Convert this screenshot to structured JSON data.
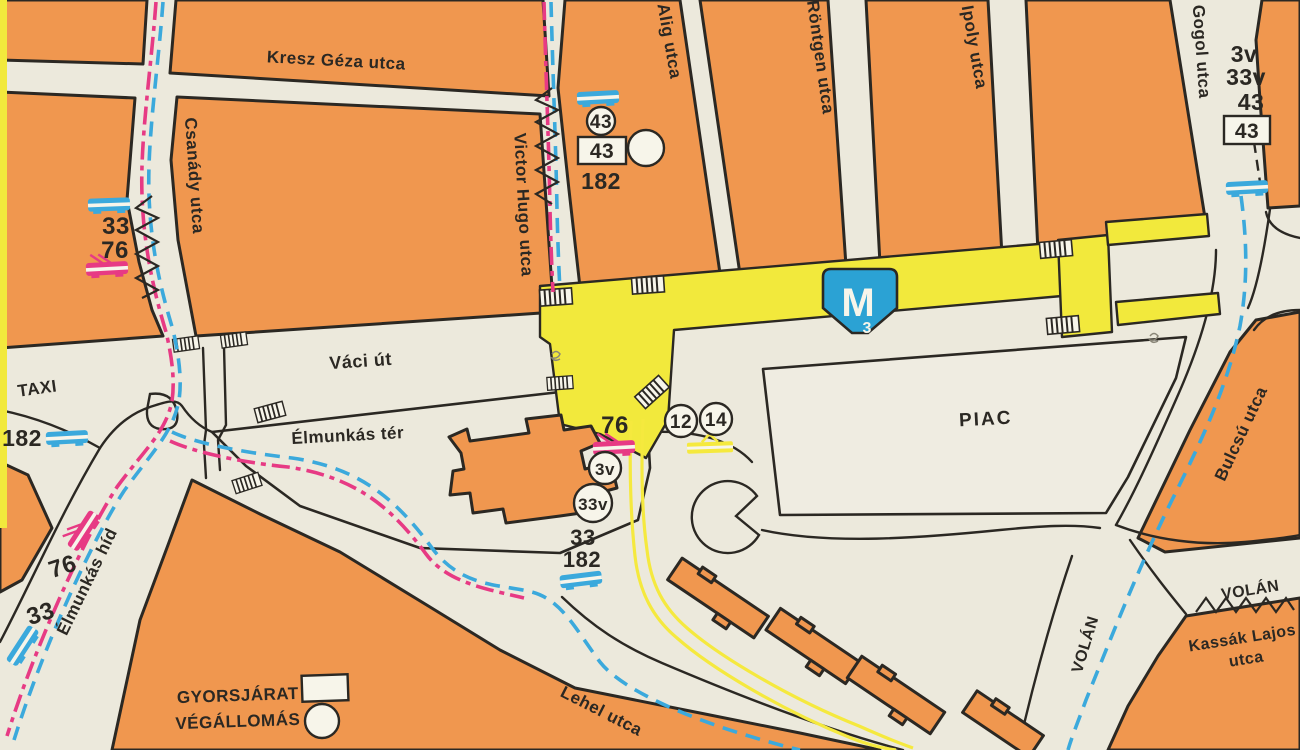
{
  "colors": {
    "background": "#ECE9DC",
    "paper": "#F7F5EA",
    "block_orange": "#F0974F",
    "ink": "#2B2823",
    "metro_yellow": "#F2E93C",
    "tram_yellow": "#F5E93E",
    "route_blue": "#3BA9DC",
    "route_pink": "#E73A84",
    "badge_blue": "#2BA2D4",
    "piac": "#EFECE1"
  },
  "street_labels": {
    "kresz_geza": "Kresz Géza utca",
    "csanady": "Csanády utca",
    "victor_hugo": "Victor Hugo utca",
    "alig": "Alig utca",
    "rontgen": "Röntgen utca",
    "ipoly": "Ipoly utca",
    "gogol": "Gogol utca",
    "vaci_ut": "Váci út",
    "elmunkas_ter": "Élmunkás tér",
    "elmunkas_hid": "Élmunkás híd",
    "lehel": "Lehel utca",
    "bulcsu": "Bulcsú utca",
    "kassak_lajos": "Kassák Lajos",
    "kassak_utca": "utca",
    "volan_east": "VOLÁN",
    "volan_south": "VOLÁN",
    "taxi": "TAXI",
    "piac": "PIAC"
  },
  "legend": {
    "express": "GYORSJÁRAT",
    "terminus": "VÉGÁLLOMÁS"
  },
  "metro_badge": {
    "letter": "M",
    "line_number": "3"
  },
  "stops": {
    "nw_bus_33": "33",
    "nw_trolley_76": "76",
    "west_bus_182": "182",
    "bridge_trolley_76": "76",
    "bridge_bus_33": "33",
    "victor_hugo_circle_43": "43",
    "victor_hugo_box_43": "43",
    "victor_hugo_182": "182",
    "center_trolley_76": "76",
    "center_circle_3v": "3v",
    "center_circle_33v": "33v",
    "center_33": "33",
    "center_182": "182",
    "tram_circle_12": "12",
    "tram_circle_14": "14",
    "northeast_3v": "3v",
    "northeast_33v": "33v",
    "northeast_43": "43",
    "northeast_box_43": "43"
  }
}
